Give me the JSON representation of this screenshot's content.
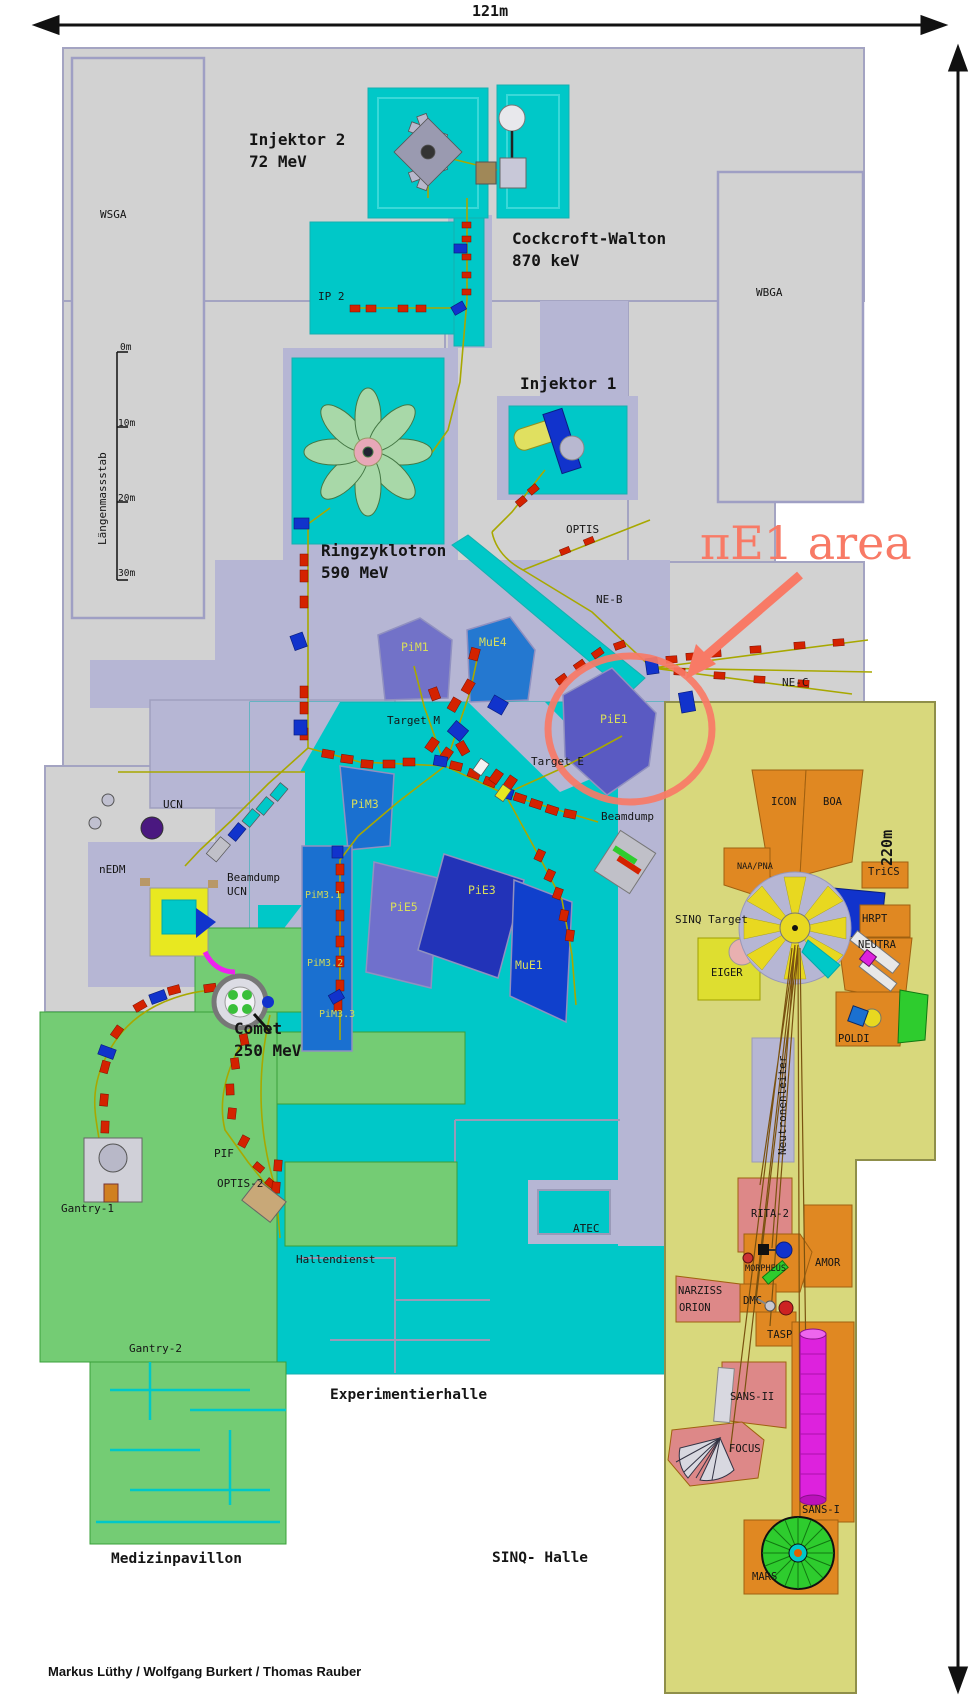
{
  "scale": {
    "width_label": "121m",
    "height_label": "220m"
  },
  "annotation": {
    "text": "πE1 area",
    "color": "#f87a66"
  },
  "credits": "Markus Lüthy / Wolfgang Burkert / Thomas Rauber",
  "colors": {
    "annotation_accent": "#f87a66",
    "hall_cyan": "#00c8c8",
    "building_gray": "#d2d2d2",
    "corridor_lavender": "#b6b6d4",
    "medical_green": "#74cc74",
    "sinq_khaki": "#d8d87c",
    "instrument_orange": "#e08822",
    "platform_salmon": "#dd8888",
    "magnet_red": "#d42200",
    "magnet_blue": "#1133cc",
    "beamline_olive": "#a8a800"
  },
  "map_labels": [
    {
      "group": "scale_ruler",
      "items": [
        {
          "id": "ruler-title",
          "text": "Längenmassstab",
          "x": 96,
          "y": 545,
          "cls": "s v"
        },
        {
          "id": "tick-0m",
          "text": "0m",
          "x": 120,
          "y": 342,
          "cls": "ss"
        },
        {
          "id": "tick-10m",
          "text": "10m",
          "x": 118,
          "y": 418,
          "cls": "ss"
        },
        {
          "id": "tick-20m",
          "text": "20m",
          "x": 118,
          "y": 493,
          "cls": "ss"
        },
        {
          "id": "tick-30m",
          "text": "30m",
          "x": 118,
          "y": 568,
          "cls": "ss"
        }
      ]
    },
    {
      "group": "accelerators",
      "items": [
        {
          "id": "injektor2",
          "text": "Injektor 2\n72 MeV",
          "x": 249,
          "y": 129,
          "cls": "t"
        },
        {
          "id": "cockcroft-walton",
          "text": "Cockcroft-Walton\n870 keV",
          "x": 512,
          "y": 228,
          "cls": "t"
        },
        {
          "id": "injektor1",
          "text": "Injektor 1",
          "x": 520,
          "y": 373,
          "cls": "t"
        },
        {
          "id": "ringzyklotron",
          "text": "Ringzyklotron\n590 MeV",
          "x": 321,
          "y": 540,
          "cls": "t"
        },
        {
          "id": "comet",
          "text": "Comet\n250 MeV",
          "x": 234,
          "y": 1018,
          "cls": "t"
        }
      ]
    },
    {
      "group": "buildings",
      "items": [
        {
          "id": "wsga",
          "text": "WSGA",
          "x": 100,
          "y": 208,
          "cls": "s"
        },
        {
          "id": "wbga",
          "text": "WBGA",
          "x": 756,
          "y": 286,
          "cls": "s"
        },
        {
          "id": "ip2",
          "text": "IP 2",
          "x": 318,
          "y": 290,
          "cls": "s"
        },
        {
          "id": "optis",
          "text": "OPTIS",
          "x": 566,
          "y": 523,
          "cls": "s"
        },
        {
          "id": "ne-b",
          "text": "NE-B",
          "x": 596,
          "y": 593,
          "cls": "s"
        },
        {
          "id": "ne-c",
          "text": "NE-C",
          "x": 782,
          "y": 676,
          "cls": "s"
        },
        {
          "id": "target-m",
          "text": "Target M",
          "x": 387,
          "y": 714,
          "cls": "s"
        },
        {
          "id": "target-e",
          "text": "Target E",
          "x": 531,
          "y": 755,
          "cls": "s"
        },
        {
          "id": "beamdump",
          "text": "Beamdump",
          "x": 601,
          "y": 810,
          "cls": "s"
        },
        {
          "id": "ucn",
          "text": "UCN",
          "x": 163,
          "y": 798,
          "cls": "s"
        },
        {
          "id": "nedm",
          "text": "nEDM",
          "x": 99,
          "y": 863,
          "cls": "s"
        },
        {
          "id": "beamdump-ucn",
          "text": "Beamdump\nUCN",
          "x": 227,
          "y": 871,
          "cls": "s"
        },
        {
          "id": "pif",
          "text": "PIF",
          "x": 214,
          "y": 1147,
          "cls": "s"
        },
        {
          "id": "optis-2",
          "text": "OPTIS-2",
          "x": 217,
          "y": 1177,
          "cls": "s"
        },
        {
          "id": "gantry-1",
          "text": "Gantry-1",
          "x": 61,
          "y": 1202,
          "cls": "s"
        },
        {
          "id": "gantry-2",
          "text": "Gantry-2",
          "x": 129,
          "y": 1342,
          "cls": "s"
        },
        {
          "id": "hallendienst",
          "text": "Hallendienst",
          "x": 296,
          "y": 1253,
          "cls": "s"
        },
        {
          "id": "atec",
          "text": "ATEC",
          "x": 573,
          "y": 1222,
          "cls": "s"
        },
        {
          "id": "sinq-target",
          "text": "SINQ Target",
          "x": 675,
          "y": 913,
          "cls": "s"
        },
        {
          "id": "neutronenleiter",
          "text": "Neutronenleiter",
          "x": 776,
          "y": 1155,
          "cls": "s v"
        }
      ]
    },
    {
      "group": "beamline_areas",
      "items": [
        {
          "id": "pim1",
          "text": "PiM1",
          "x": 401,
          "y": 640,
          "cls": "b"
        },
        {
          "id": "mue4",
          "text": "MuE4",
          "x": 479,
          "y": 635,
          "cls": "b"
        },
        {
          "id": "pie1",
          "text": "PiE1",
          "x": 600,
          "y": 712,
          "cls": "b"
        },
        {
          "id": "pim3",
          "text": "PiM3",
          "x": 351,
          "y": 797,
          "cls": "b"
        },
        {
          "id": "pie5",
          "text": "PiE5",
          "x": 390,
          "y": 900,
          "cls": "b"
        },
        {
          "id": "pie3",
          "text": "PiE3",
          "x": 468,
          "y": 883,
          "cls": "b"
        },
        {
          "id": "mue1",
          "text": "MuE1",
          "x": 515,
          "y": 958,
          "cls": "b"
        },
        {
          "id": "pim3-1",
          "text": "PiM3.1",
          "x": 305,
          "y": 889,
          "cls": "bs"
        },
        {
          "id": "pim3-2",
          "text": "PiM3.2",
          "x": 307,
          "y": 957,
          "cls": "bs"
        },
        {
          "id": "pim3-3",
          "text": "PiM3.3",
          "x": 319,
          "y": 1008,
          "cls": "bs"
        }
      ]
    },
    {
      "group": "sinq_instruments",
      "items": [
        {
          "id": "icon",
          "text": "ICON",
          "x": 771,
          "y": 796,
          "cls": "i"
        },
        {
          "id": "boa",
          "text": "BOA",
          "x": 823,
          "y": 796,
          "cls": "i"
        },
        {
          "id": "naa-pna",
          "text": "NAA/PNA",
          "x": 737,
          "y": 862,
          "cls": "is"
        },
        {
          "id": "trics",
          "text": "TriCS",
          "x": 868,
          "y": 866,
          "cls": "i"
        },
        {
          "id": "hrpt",
          "text": "HRPT",
          "x": 862,
          "y": 913,
          "cls": "i"
        },
        {
          "id": "neutra",
          "text": "NEUTRA",
          "x": 858,
          "y": 939,
          "cls": "i"
        },
        {
          "id": "eiger",
          "text": "EIGER",
          "x": 711,
          "y": 967,
          "cls": "i"
        },
        {
          "id": "poldi",
          "text": "POLDI",
          "x": 838,
          "y": 1033,
          "cls": "i"
        },
        {
          "id": "rita-2",
          "text": "RITA-2",
          "x": 751,
          "y": 1208,
          "cls": "i"
        },
        {
          "id": "amor",
          "text": "AMOR",
          "x": 815,
          "y": 1257,
          "cls": "i"
        },
        {
          "id": "morpheus",
          "text": "MORPHEUS",
          "x": 745,
          "y": 1264,
          "cls": "is"
        },
        {
          "id": "narziss",
          "text": "NARZISS",
          "x": 678,
          "y": 1285,
          "cls": "i"
        },
        {
          "id": "orion",
          "text": "ORION",
          "x": 679,
          "y": 1302,
          "cls": "i"
        },
        {
          "id": "dmc",
          "text": "DMC",
          "x": 743,
          "y": 1295,
          "cls": "i"
        },
        {
          "id": "tasp",
          "text": "TASP",
          "x": 767,
          "y": 1329,
          "cls": "i"
        },
        {
          "id": "sans-ii",
          "text": "SANS-II",
          "x": 730,
          "y": 1391,
          "cls": "i"
        },
        {
          "id": "focus",
          "text": "FOCUS",
          "x": 729,
          "y": 1443,
          "cls": "i"
        },
        {
          "id": "sans-i",
          "text": "SANS-I",
          "x": 802,
          "y": 1504,
          "cls": "i"
        },
        {
          "id": "mars",
          "text": "MARS",
          "x": 752,
          "y": 1571,
          "cls": "i"
        }
      ]
    },
    {
      "group": "halls",
      "items": [
        {
          "id": "experimentierhalle",
          "text": "Experimentierhalle",
          "x": 330,
          "y": 1386,
          "cls": "h"
        },
        {
          "id": "medizinpavillon",
          "text": "Medizinpavillon",
          "x": 111,
          "y": 1550,
          "cls": "h"
        },
        {
          "id": "sinq-halle",
          "text": "SINQ- Halle",
          "x": 492,
          "y": 1549,
          "cls": "h"
        }
      ]
    }
  ]
}
